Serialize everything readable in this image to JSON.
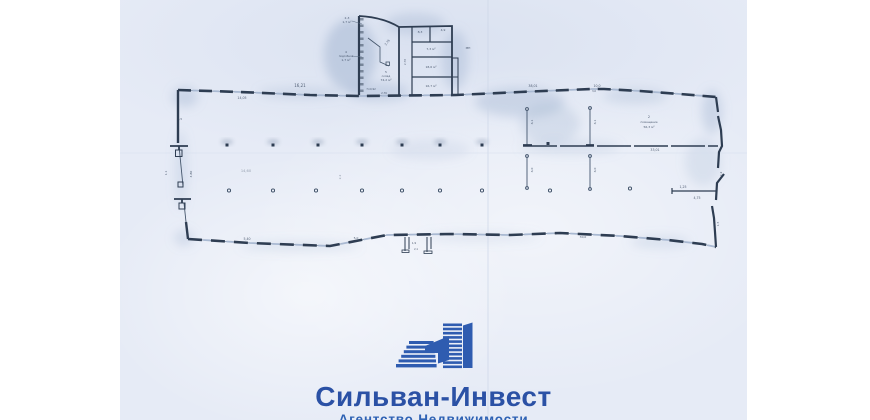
{
  "logo": {
    "title": "Сильван-Инвест",
    "subtitle": "Агентство Недвижимости",
    "title_color": "#2b51a5",
    "subtitle_color": "#2f62b4",
    "mark_color": "#2f5cb0",
    "mark_name": "buildings-icon"
  },
  "plan": {
    "paper_color": "#e6ebf6",
    "line_color": "#2e3d52",
    "window_color": "#a9b9d2",
    "shadow_color": "#8ea4c6",
    "labels": [
      {
        "x": 300,
        "y": 87,
        "t": "16,21",
        "s": 4
      },
      {
        "x": 242,
        "y": 99,
        "t": "14,05",
        "s": 3.2
      },
      {
        "x": 533,
        "y": 87,
        "t": "38,01",
        "s": 3.2
      },
      {
        "x": 597,
        "y": 87,
        "t": "10,0",
        "s": 3.2
      },
      {
        "x": 594,
        "y": 92,
        "t": "3,0",
        "s": 2.6
      },
      {
        "x": 347,
        "y": 19,
        "t": "2-3",
        "s": 3
      },
      {
        "x": 347,
        "y": 23,
        "t": "1,7 м²",
        "s": 3
      },
      {
        "x": 346,
        "y": 53,
        "t": "4",
        "s": 3
      },
      {
        "x": 346,
        "y": 57,
        "t": "подсобное",
        "s": 2.6
      },
      {
        "x": 346,
        "y": 61,
        "t": "1,7 м²",
        "s": 3
      },
      {
        "x": 388,
        "y": 43,
        "t": "2,76",
        "s": 3,
        "r": -52
      },
      {
        "x": 386,
        "y": 73,
        "t": "5",
        "s": 3
      },
      {
        "x": 386,
        "y": 77,
        "t": "склад",
        "s": 2.8
      },
      {
        "x": 386,
        "y": 81,
        "t": "74,2 м²",
        "s": 3
      },
      {
        "x": 371,
        "y": 90,
        "t": "7×0,92",
        "s": 2.6
      },
      {
        "x": 384,
        "y": 94,
        "t": "2,76",
        "s": 2.6
      },
      {
        "x": 420,
        "y": 33,
        "t": "8,3",
        "s": 3
      },
      {
        "x": 443,
        "y": 31,
        "t": "4,9",
        "s": 3
      },
      {
        "x": 431,
        "y": 50,
        "t": "7,3 м²",
        "s": 3
      },
      {
        "x": 431,
        "y": 68,
        "t": "18,6 м²",
        "s": 3
      },
      {
        "x": 431,
        "y": 87,
        "t": "16,7 м²",
        "s": 3
      },
      {
        "x": 406,
        "y": 62,
        "t": "2,76",
        "s": 2.8,
        "r": -90
      },
      {
        "x": 468,
        "y": 49,
        "t": "МП",
        "s": 3
      },
      {
        "x": 649,
        "y": 118,
        "t": "2",
        "s": 3.4
      },
      {
        "x": 649,
        "y": 123,
        "t": "помещение",
        "s": 2.8
      },
      {
        "x": 649,
        "y": 128,
        "t": "56,3 м²",
        "s": 3
      },
      {
        "x": 655,
        "y": 151,
        "t": "33,01",
        "s": 3.2
      },
      {
        "x": 683,
        "y": 188,
        "t": "1,25",
        "s": 3.2
      },
      {
        "x": 697,
        "y": 199,
        "t": "4,75",
        "s": 3.2
      },
      {
        "x": 533,
        "y": 122,
        "t": "6,1",
        "s": 3,
        "r": -90
      },
      {
        "x": 533,
        "y": 170,
        "t": "6,0",
        "s": 3,
        "r": -90
      },
      {
        "x": 596,
        "y": 122,
        "t": "6,1",
        "s": 3,
        "r": -90
      },
      {
        "x": 596,
        "y": 170,
        "t": "6,0",
        "s": 3,
        "r": -90
      },
      {
        "x": 167,
        "y": 173,
        "t": "1,1",
        "s": 3,
        "r": -90
      },
      {
        "x": 192,
        "y": 174,
        "t": "4,80",
        "s": 3,
        "r": -90
      },
      {
        "x": 180,
        "y": 120,
        "t": "4,5",
        "s": 2.8
      },
      {
        "x": 247,
        "y": 240,
        "t": "5,40",
        "s": 3.2
      },
      {
        "x": 356,
        "y": 239,
        "t": "5,0",
        "s": 3
      },
      {
        "x": 414,
        "y": 244,
        "t": "1,9",
        "s": 2.8
      },
      {
        "x": 416,
        "y": 250,
        "t": "2,1",
        "s": 2.6
      },
      {
        "x": 583,
        "y": 238,
        "t": "30,0",
        "s": 3
      },
      {
        "x": 722,
        "y": 174,
        "t": "2,2",
        "s": 3,
        "r": -90
      },
      {
        "x": 719,
        "y": 224,
        "t": "1,5",
        "s": 3,
        "r": -90
      },
      {
        "x": 246,
        "y": 172,
        "t": "14,60",
        "s": 3.6,
        "o": 0.55
      },
      {
        "x": 341,
        "y": 177,
        "t": "2,2",
        "s": 3,
        "r": -90,
        "o": 0.6
      }
    ]
  }
}
